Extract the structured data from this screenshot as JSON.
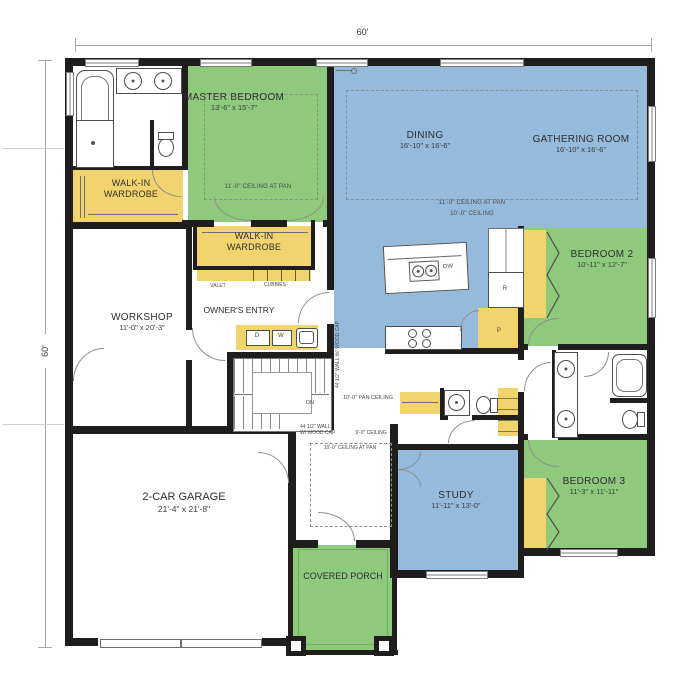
{
  "colors": {
    "green": "#8ec97c",
    "blue": "#95badb",
    "yellow": "#f2d46e",
    "wall": "#201d1d"
  },
  "dimensions": {
    "top": "60'",
    "left": "60'"
  },
  "rooms": {
    "master_bedroom": {
      "label": "MASTER BEDROOM",
      "dims": "13'-6\" x 15'-7\"",
      "ceiling_note": "11'-0\" CEILING AT PAN"
    },
    "walk_in_wardrobe_1": {
      "label": "WALK-IN WARDROBE"
    },
    "walk_in_wardrobe_2": {
      "label": "WALK-IN WARDROBE"
    },
    "dining": {
      "label": "DINING",
      "dims": "16'-10\" x 16'-6\""
    },
    "gathering_room": {
      "label": "GATHERING ROOM",
      "dims": "16'-10\" x 16'-6\""
    },
    "bedroom_2": {
      "label": "BEDROOM 2",
      "dims": "10'-11\" x 12'-7\""
    },
    "bedroom_3": {
      "label": "BEDROOM 3",
      "dims": "11'-3\" x 11'-11\""
    },
    "study": {
      "label": "STUDY",
      "dims": "11'-11\" x 13'-0\""
    },
    "workshop": {
      "label": "WORKSHOP",
      "dims": "11'-0\" x 20'-3\""
    },
    "owners_entry": {
      "label": "OWNER'S ENTRY"
    },
    "garage": {
      "label": "2-CAR GARAGE",
      "dims": "21'-4\" x 21'-8\""
    },
    "covered_porch": {
      "label": "COVERED PORCH"
    }
  },
  "ceiling_notes": {
    "great_room_pan": "11'-0\" CEILING AT PAN",
    "great_room": "10'-0\" CEILING",
    "stair_hall_pan": "10'-0\" PAN CEILING",
    "foyer": "9'-0\" CEILING",
    "foyer_pan": "10'-0\" CEILING AT PAN"
  },
  "wall_notes": {
    "stair_rail": "44 1/2\" WALL W/ WOOD CAP",
    "foyer_rail_line1": "44 1/2\" WALL",
    "foyer_rail_line2": "W/ WOOD CAP"
  },
  "casework": {
    "valet": "VALET",
    "cubbies": "CUBBIES"
  },
  "stairs": {
    "down": "DN"
  },
  "appliances": {
    "dryer": "D",
    "washer": "W",
    "dishwasher": "DW",
    "refrigerator": "R",
    "pantry": "P"
  }
}
